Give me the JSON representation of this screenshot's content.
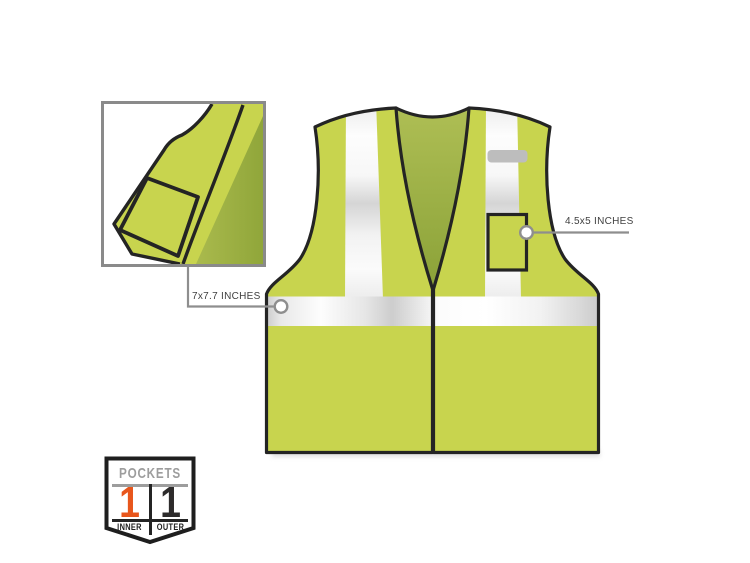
{
  "page": {
    "background": "#ffffff"
  },
  "callouts": {
    "inner_pocket": {
      "label": "7x7.7 INCHES"
    },
    "outer_pocket": {
      "label": "4.5x5 INCHES"
    }
  },
  "badge": {
    "title": "POCKETS",
    "cells": [
      {
        "count": "1",
        "label": "INNER",
        "count_color": "#e8561c"
      },
      {
        "count": "1",
        "label": "OUTER",
        "count_color": "#2d2b2b"
      }
    ]
  },
  "colors": {
    "vest_lime": "#c8d44e",
    "vest_inner_green": "#96aa3e",
    "outline_black": "#242424",
    "reflective_silver": "#e9e9e9",
    "callout_gray": "#8e8e8e",
    "tab_gray": "#bdbdbd",
    "inset_border_gray": "#8a8a8a",
    "badge_title_gray": "#9d9d9d",
    "badge_orange": "#e8561c"
  }
}
